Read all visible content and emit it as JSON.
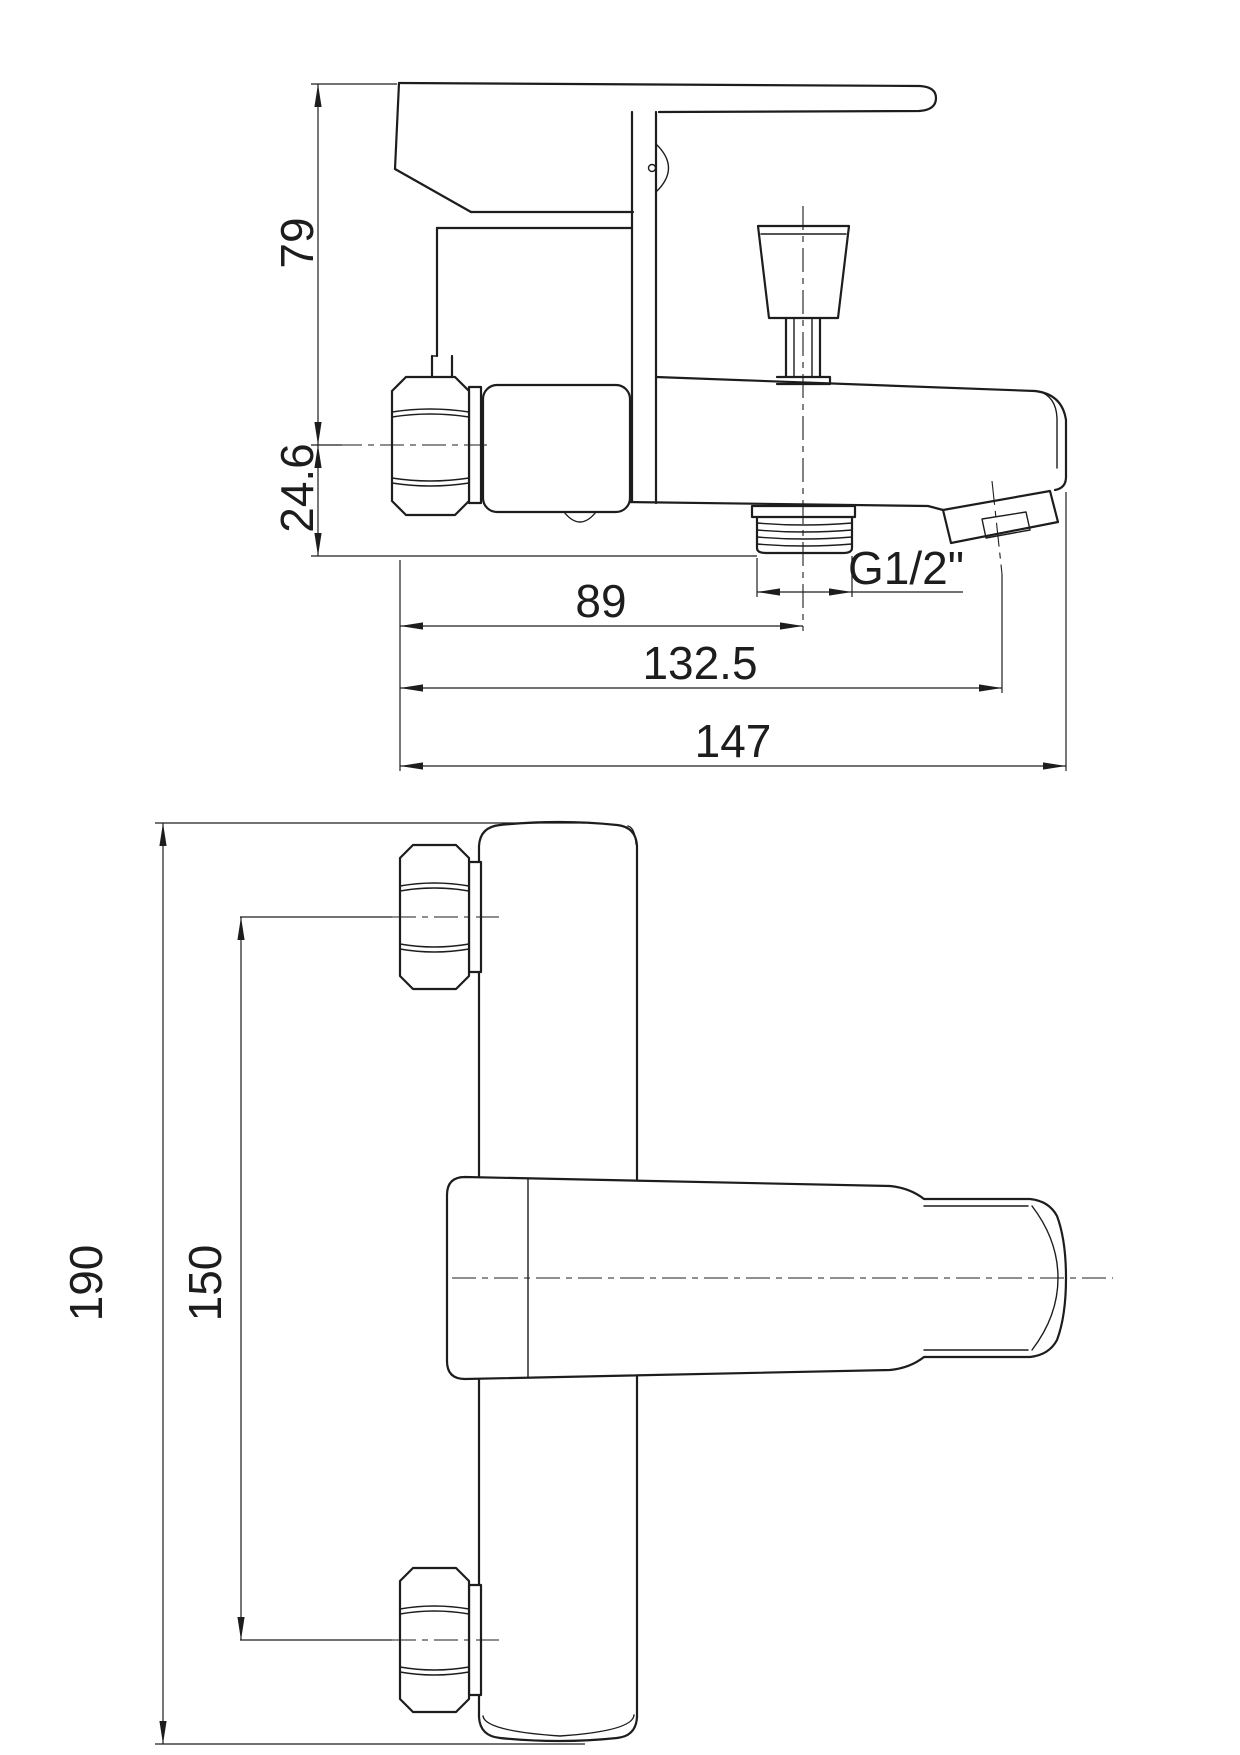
{
  "drawing": {
    "kind": "technical-drawing",
    "subject": "wall-mounted bath mixer faucet, two orthographic views",
    "background_color": "#ffffff",
    "line_color": "#1d1d1d",
    "views": {
      "side": {
        "name": "side-elevation",
        "dimensions": {
          "handle_height": {
            "label": "79"
          },
          "body_drop": {
            "label": "24.6"
          },
          "outlet_offset": {
            "label": "89"
          },
          "outlet_thread": {
            "label": "G1/2\""
          },
          "spout_tip_offset": {
            "label": "132.5"
          },
          "overall_depth": {
            "label": "147"
          }
        }
      },
      "plan": {
        "name": "plan-view",
        "dimensions": {
          "overall_width": {
            "label": "190"
          },
          "connection_centres": {
            "label": "150"
          }
        }
      }
    }
  }
}
